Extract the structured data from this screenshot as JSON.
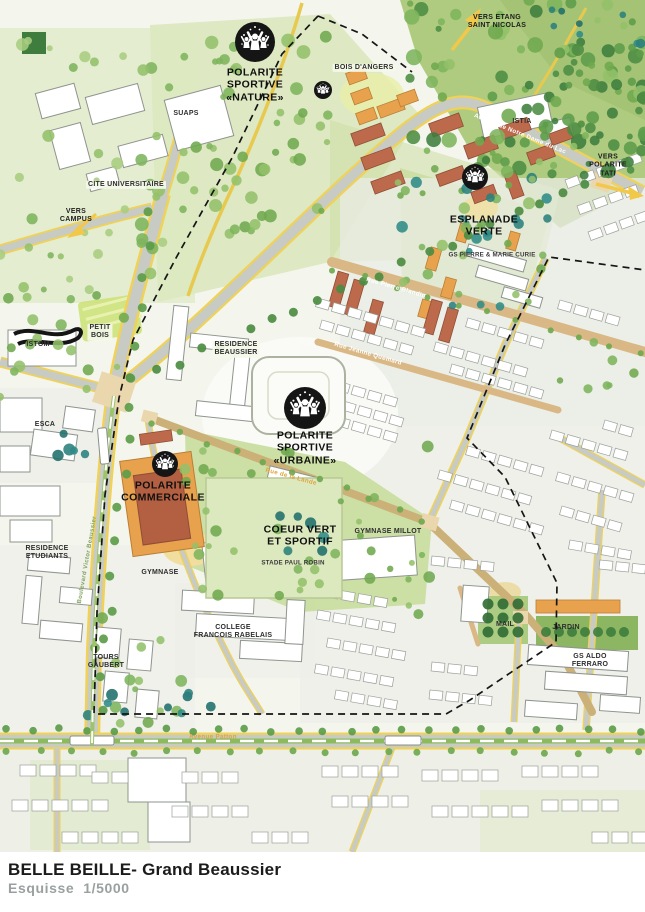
{
  "palette": {
    "forest_green": "#AECB7F",
    "park_green": "#C9DDA0",
    "pale_green_wash": "#DFE9C6",
    "tree_dark": "#4C8C42",
    "tree_mid": "#6FA84F",
    "tree_light": "#93C06A",
    "tree_teal": "#2A7F7C",
    "road_gray": "#C7CBC3",
    "road_yellow": "#EFD257",
    "path_tan": "#D9B886",
    "node_tan": "#EAD7AE",
    "building_white": "#FFFFFF",
    "building_orange": "#E8A24E",
    "building_brick": "#BD6A4C",
    "perimeter_black": "#151515",
    "icon_black": "#151515",
    "title_black": "#1B1B1B",
    "subtitle_gray": "#9AA0A0"
  },
  "map": {
    "labels": [
      {
        "id": "vers-etang-label",
        "text": "VERS ETANG\nSAINT NICOLAS",
        "x": 497,
        "y": 22,
        "cls": "dir",
        "rot": 0
      },
      {
        "id": "bois-dangers-label",
        "text": "BOIS D'ANGERS",
        "x": 364,
        "y": 68,
        "cls": "chip",
        "rot": 0
      },
      {
        "id": "polarite-sportive-nature-label",
        "text": "POLARITE\nSPORTIVE\n«NATURE»",
        "x": 255,
        "y": 85,
        "cls": "big",
        "rot": 0
      },
      {
        "id": "suaps-label",
        "text": "SUAPS",
        "x": 186,
        "y": 114,
        "cls": "place",
        "rot": 0
      },
      {
        "id": "istia-label",
        "text": "ISTIA",
        "x": 522,
        "y": 122,
        "cls": "place",
        "rot": 0
      },
      {
        "id": "vers-polarite-tati-label",
        "text": "VERS\nPOLARITE TATI",
        "x": 608,
        "y": 166,
        "cls": "dir",
        "rot": 0
      },
      {
        "id": "cite-universitaire-label",
        "text": "CITE UNIVERSITAIRE",
        "x": 126,
        "y": 185,
        "cls": "chip",
        "rot": 0
      },
      {
        "id": "esplanade-verte-label",
        "text": "ESPLANADE\nVERTE",
        "x": 484,
        "y": 226,
        "cls": "big",
        "rot": 0
      },
      {
        "id": "vers-campus-label",
        "text": "VERS\nCAMPUS",
        "x": 76,
        "y": 216,
        "cls": "dir",
        "rot": 0
      },
      {
        "id": "gs-pierre-marie-curie-label",
        "text": "GS PIERRE & MARIE CURIE",
        "x": 492,
        "y": 255,
        "cls": "tiny",
        "rot": 0
      },
      {
        "id": "avenue-notre-dame-du-lac-label",
        "text": "Avenue de Notre Dame du Lac",
        "x": 520,
        "y": 134,
        "cls": "street",
        "rot": 22
      },
      {
        "id": "rue-pierre-blandin-label",
        "text": "Rue Pierre Blandin",
        "x": 396,
        "y": 288,
        "cls": "street",
        "rot": 16
      },
      {
        "id": "petit-bois-label",
        "text": "PETIT\nBOIS",
        "x": 100,
        "y": 332,
        "cls": "chip",
        "rot": 0
      },
      {
        "id": "istom-label",
        "text": "ISTOM",
        "x": 38,
        "y": 345,
        "cls": "place",
        "rot": 0
      },
      {
        "id": "residence-beaussier-label",
        "text": "RESIDENCE\nBEAUSSIER",
        "x": 236,
        "y": 349,
        "cls": "chip",
        "rot": 0
      },
      {
        "id": "rue-jeanne-quemard-label",
        "text": "Rue Jeanne Quemard",
        "x": 368,
        "y": 354,
        "cls": "street",
        "rot": 16
      },
      {
        "id": "esca-label",
        "text": "ESCA",
        "x": 45,
        "y": 425,
        "cls": "place",
        "rot": 0
      },
      {
        "id": "polarite-sportive-urbaine-label",
        "text": "POLARITE\nSPORTIVE\n«URBAINE»",
        "x": 305,
        "y": 448,
        "cls": "big",
        "rot": 0
      },
      {
        "id": "polarite-commerciale-label",
        "text": "POLARITE\nCOMMERCIALE",
        "x": 163,
        "y": 492,
        "cls": "big",
        "rot": 0
      },
      {
        "id": "rue-de-la-lande-label",
        "text": "Rue de la Lande",
        "x": 291,
        "y": 477,
        "cls": "street-o",
        "rot": 15
      },
      {
        "id": "coeur-vert-label",
        "text": "COEUR VERT\nET SPORTIF",
        "x": 300,
        "y": 536,
        "cls": "big",
        "rot": 0
      },
      {
        "id": "gymnase-millot-label",
        "text": "GYMNASE MILLOT",
        "x": 388,
        "y": 532,
        "cls": "place",
        "rot": 0
      },
      {
        "id": "stade-paul-robin-label",
        "text": "STADE PAUL ROBIN",
        "x": 293,
        "y": 563,
        "cls": "tiny",
        "rot": 0
      },
      {
        "id": "residence-etudiants-label",
        "text": "RESIDENCE\nETUDIANTS",
        "x": 47,
        "y": 553,
        "cls": "place",
        "rot": 0
      },
      {
        "id": "gymnase-label",
        "text": "GYMNASE",
        "x": 160,
        "y": 573,
        "cls": "place",
        "rot": 0
      },
      {
        "id": "boulevard-victor-beaussier-label",
        "text": "Boulevard Victor Beaussier",
        "x": 88,
        "y": 560,
        "cls": "street-g",
        "rot": -80
      },
      {
        "id": "college-rabelais-label",
        "text": "COLLEGE\nFRANCOIS RABELAIS",
        "x": 233,
        "y": 632,
        "cls": "place",
        "rot": 0
      },
      {
        "id": "mail-label",
        "text": "MAIL",
        "x": 505,
        "y": 625,
        "cls": "place",
        "rot": 0
      },
      {
        "id": "jardin-label",
        "text": "JARDIN",
        "x": 566,
        "y": 628,
        "cls": "place",
        "rot": 0
      },
      {
        "id": "tours-gaubert-label",
        "text": "TOURS\nGAUBERT",
        "x": 106,
        "y": 662,
        "cls": "place",
        "rot": 0
      },
      {
        "id": "gs-aldo-ferraro-label",
        "text": "GS ALDO FERRARO",
        "x": 590,
        "y": 661,
        "cls": "place",
        "rot": 0
      },
      {
        "id": "avenue-patton-label",
        "text": "Avenue Patton",
        "x": 213,
        "y": 737,
        "cls": "street-o",
        "rot": 0
      }
    ],
    "icons": [
      {
        "id": "polarite-sportive-nature-icon",
        "x": 255,
        "y": 42,
        "r": 20
      },
      {
        "id": "polarite-nature-small-icon",
        "x": 323,
        "y": 90,
        "r": 9
      },
      {
        "id": "esplanade-verte-icon",
        "x": 475,
        "y": 177,
        "r": 13
      },
      {
        "id": "polarite-sportive-urbaine-icon",
        "x": 305,
        "y": 408,
        "r": 21
      },
      {
        "id": "polarite-commerciale-icon",
        "x": 165,
        "y": 464,
        "r": 13
      }
    ]
  },
  "footer": {
    "title": "BELLE BEILLE- Grand Beaussier",
    "subtitle": "Esquisse  1/5000"
  }
}
